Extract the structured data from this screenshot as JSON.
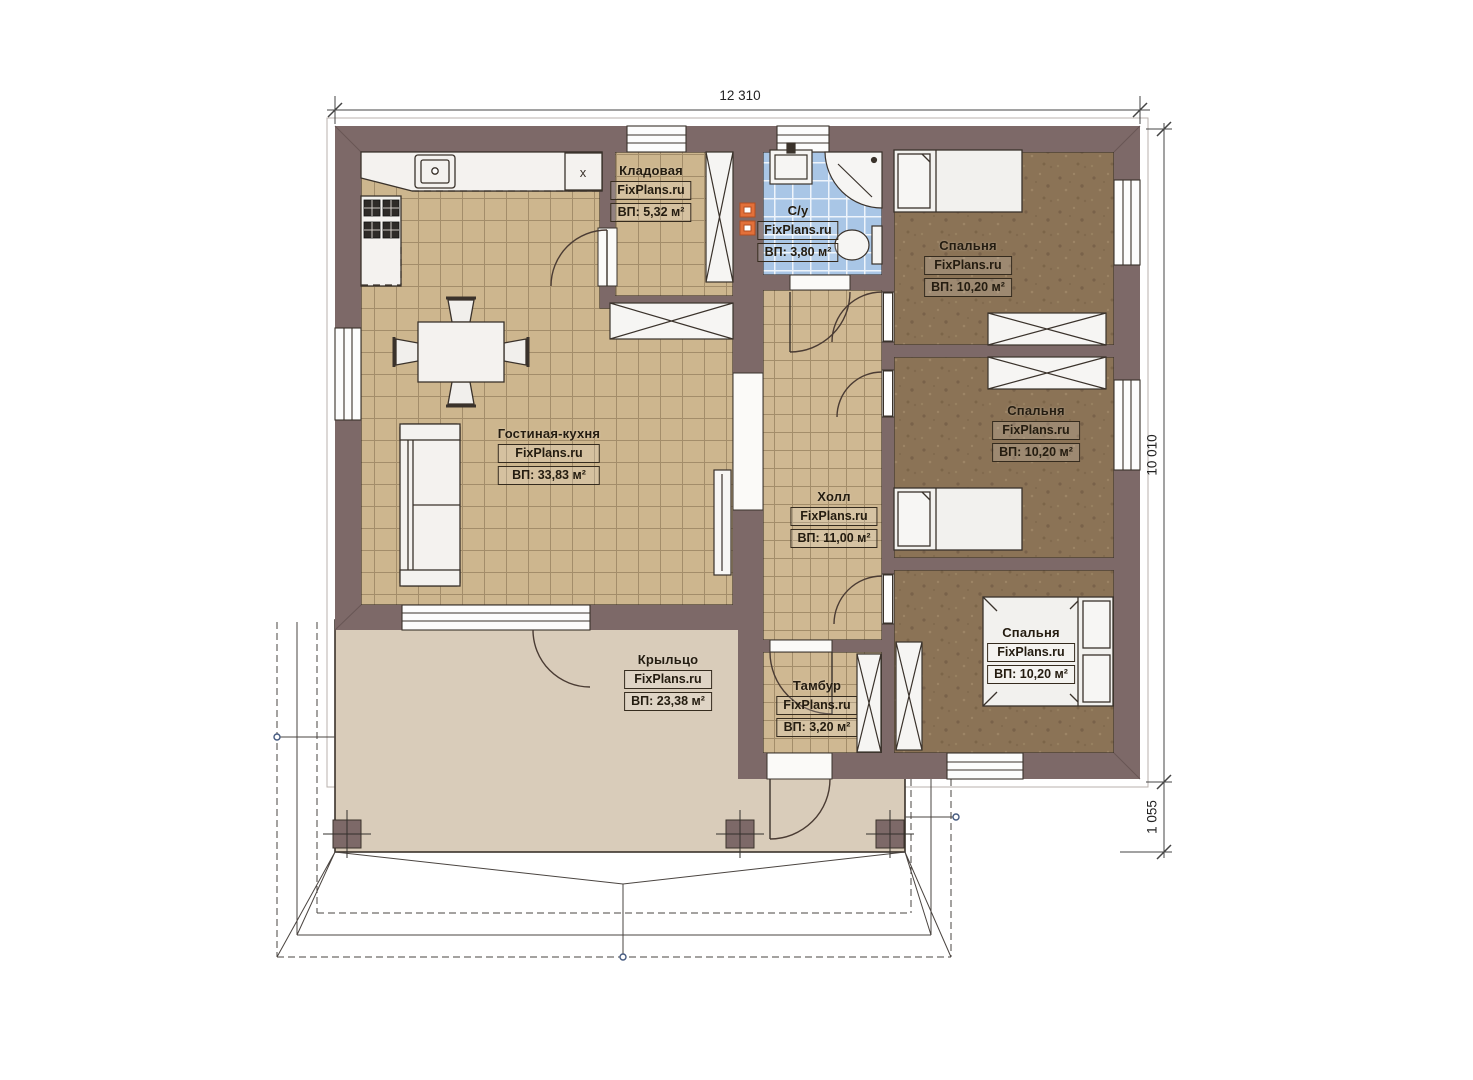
{
  "plan": {
    "brand": "FixPlans.ru",
    "dimensions": {
      "width_top": "12 310",
      "height_right": "10 010",
      "porch_right": "1 055"
    },
    "rooms": [
      {
        "id": "kitchen-living",
        "name": "Гостиная-кухня",
        "area": "ВП: 33,83 м²"
      },
      {
        "id": "storeroom",
        "name": "Кладовая",
        "area": "ВП: 5,32 м²"
      },
      {
        "id": "bathroom",
        "name": "С/у",
        "area": "ВП: 3,80 м²"
      },
      {
        "id": "hall",
        "name": "Холл",
        "area": "ВП: 11,00 м²"
      },
      {
        "id": "bedroom-1",
        "name": "Спальня",
        "area": "ВП: 10,20 м²"
      },
      {
        "id": "bedroom-2",
        "name": "Спальня",
        "area": "ВП: 10,20 м²"
      },
      {
        "id": "bedroom-3",
        "name": "Спальня",
        "area": "ВП: 10,20 м²"
      },
      {
        "id": "vestibule",
        "name": "Тамбур",
        "area": "ВП: 3,20 м²"
      },
      {
        "id": "porch",
        "name": "Крыльцо",
        "area": "ВП: 23,38 м²"
      }
    ],
    "kitchen_marker": "x",
    "colors": {
      "wall": "#7d6968",
      "tile_floor": "#cdb68e",
      "tile_line": "#a38d6a",
      "bathroom_tile": "#a9c6e6",
      "bedroom_floor": "#8b7356",
      "porch_floor": "#d9ccba",
      "furniture": "#f4f2ef",
      "accent_orange": "#e2703a",
      "outline": "#3a322b"
    }
  }
}
